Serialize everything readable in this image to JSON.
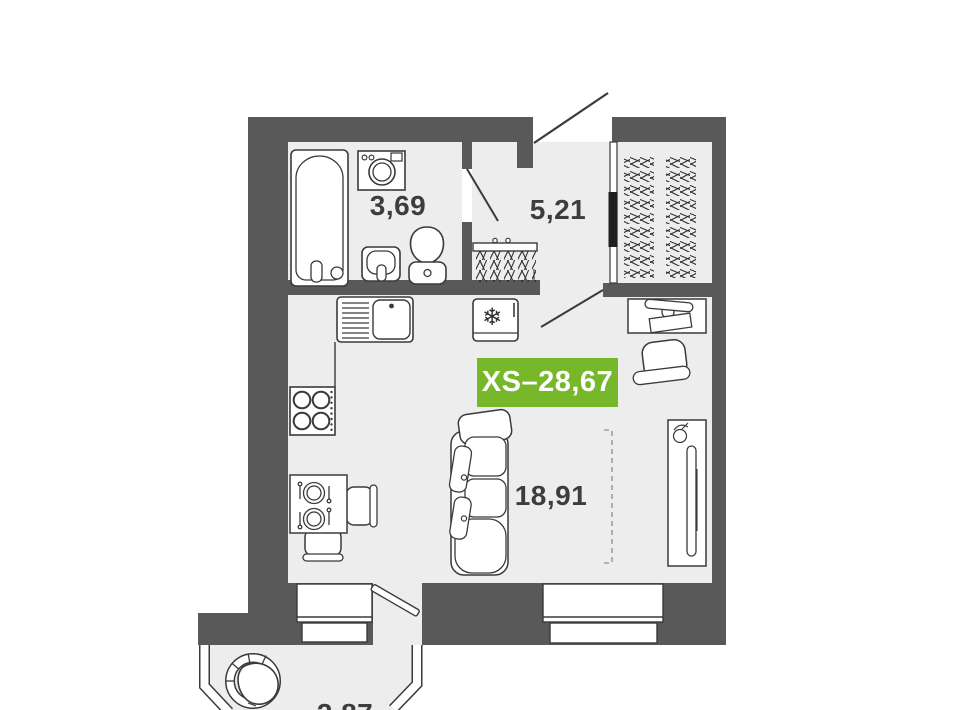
{
  "plan": {
    "unit_badge": {
      "label": "XS–28,67",
      "bg_color": "#76b82a",
      "text_color": "#ffffff"
    },
    "rooms": [
      {
        "name": "bathroom",
        "area_label": "3,69"
      },
      {
        "name": "hallway",
        "area_label": "5,21"
      },
      {
        "name": "living-kitchen",
        "area_label": "18,91"
      },
      {
        "name": "balcony",
        "area_label": "2,87"
      }
    ],
    "colors": {
      "wall": "#595959",
      "floor": "#ededed",
      "outline": "#3a3a3a",
      "background": "#ffffff",
      "dashed_marker": "#9e9e9e",
      "label_text": "#3d3d3d"
    },
    "icons": {
      "fridge_snowflake": "❄"
    },
    "fixtures": [
      "bathtub",
      "washing-machine",
      "washbasin",
      "toilet",
      "coat-rack",
      "kitchen-sink",
      "counter",
      "stove",
      "fridge",
      "dining-table",
      "dining-chairs",
      "sofa",
      "desk",
      "laptop",
      "office-chair",
      "tv-stand",
      "tv",
      "plant",
      "wardrobe-hangers",
      "balcony-armchair"
    ]
  }
}
